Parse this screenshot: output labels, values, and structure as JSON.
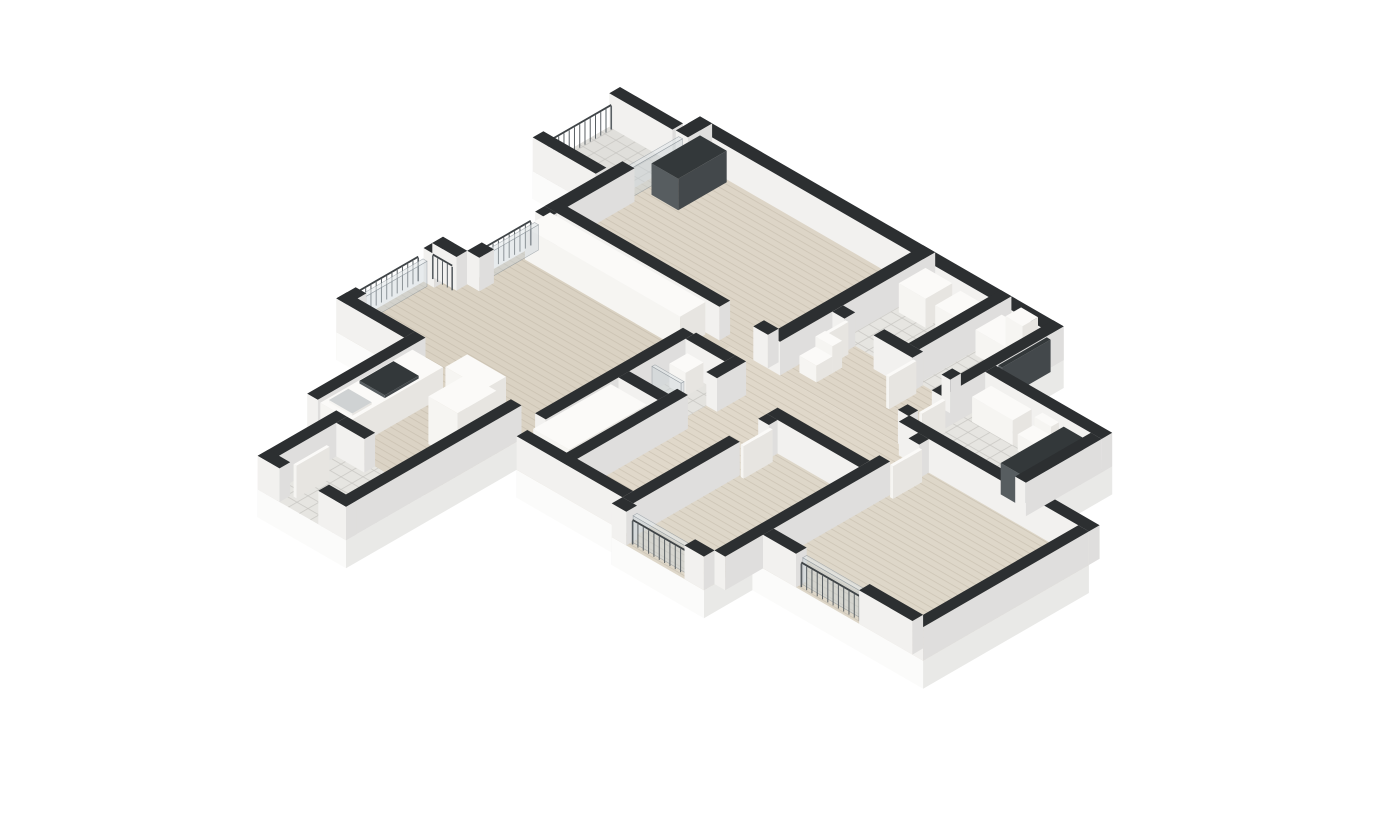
{
  "canvas": {
    "width": 1400,
    "height": 820,
    "background": "#ffffff"
  },
  "projection": {
    "cx": 700,
    "cy": 150,
    "scale": 56,
    "wall_height": 0.6,
    "rail_height": 0.42,
    "skirt_depth": 0.5
  },
  "colors": {
    "background": "#ffffff",
    "wall_top": "#2c2f31",
    "wall_face_u": "#dfdedd",
    "wall_face_v": "#f2f1ef",
    "skirt_u": "#e9e9e7",
    "skirt_v": "#fbfbfa",
    "white_top": "#fbfaf8",
    "white_u": "#e7e5e1",
    "white_v": "#f6f5f2",
    "dark_top": "#33383a",
    "dark_u": "#43484b",
    "dark_v": "#575d60",
    "sink_top": "#cfd2d3",
    "tray_top": "#f8f8f6",
    "glass_fill": "rgba(202,210,214,0.45)",
    "glass_top": "rgba(226,231,233,0.6)",
    "glass_stroke": "rgba(122,132,138,0.55)",
    "rail_bar": "#5a6064",
    "rail_top": "#3f4447",
    "wood_line": "#b7ad9c",
    "tile_line": "#c8c7c2",
    "wood_base_default": "#dcd4c6"
  },
  "scene": {
    "floors": [
      {
        "n": "balcony-floor",
        "kind": "tile",
        "base": "#e0dfdb",
        "rect": [
          -1.35,
          0.3,
          0,
          2.1
        ],
        "skirt": true
      },
      {
        "n": "bedroom-top-floor",
        "kind": "wood",
        "base": "#ddd5c7",
        "rect": [
          0,
          0,
          4.85,
          3.2
        ],
        "skirt": true
      },
      {
        "n": "bath-a-floor",
        "kind": "tile",
        "base": "#e6e5e1",
        "rect": [
          4.85,
          0,
          6.32,
          1.9
        ],
        "skirt": true
      },
      {
        "n": "bath-b-floor",
        "kind": "tile",
        "base": "#e6e5e1",
        "rect": [
          6.32,
          0,
          7.5,
          1.9
        ],
        "skirt": true
      },
      {
        "n": "hall-floor",
        "kind": "wood",
        "base": "#ded6c8",
        "rect": [
          4.85,
          1.9,
          7.5,
          3.2
        ],
        "skirt": true
      },
      {
        "n": "bathroom-2-floor",
        "kind": "tile",
        "base": "#e6e5e1",
        "rect": [
          7.5,
          1.4,
          9.9,
          3.4
        ],
        "skirt": true
      },
      {
        "n": "living-room-floor",
        "kind": "wood",
        "base": "#dad2c3",
        "pts": [
          [
            0,
            3.2
          ],
          [
            3.82,
            3.2
          ],
          [
            3.82,
            7.0
          ],
          [
            -0.5,
            7.0
          ],
          [
            -0.5,
            4.8
          ],
          [
            0,
            4.8
          ]
        ],
        "skirt": true
      },
      {
        "n": "corridor-floor",
        "kind": "wood",
        "base": "#e0d8ca",
        "rect": [
          3.82,
          3.2,
          6.0,
          7.6
        ],
        "skirt": true
      },
      {
        "n": "corridor-landing-floor",
        "kind": "wood",
        "base": "#e0d8ca",
        "rect": [
          6.0,
          3.2,
          7.9,
          4.4
        ],
        "skirt": true
      },
      {
        "n": "shower-room-floor",
        "kind": "tile",
        "base": "#e4e3df",
        "rect": [
          3.82,
          3.9,
          4.63,
          5.5
        ],
        "skirt": false
      },
      {
        "n": "kitchen-floor",
        "kind": "wood",
        "base": "#dbd3c5",
        "rect": [
          0.9,
          7.0,
          3.32,
          9.0
        ],
        "skirt": true
      },
      {
        "n": "entry-floor",
        "kind": "tile",
        "base": "#e6e5e1",
        "rect": [
          1.5,
          9.0,
          3.32,
          10.62
        ],
        "skirt": true
      },
      {
        "n": "bedroom-1-floor",
        "kind": "wood",
        "base": "#ded7c9",
        "rect": [
          6.0,
          4.4,
          7.9,
          7.82
        ],
        "skirt": true
      },
      {
        "n": "bedroom-2-floor",
        "kind": "wood",
        "base": "#ded7c9",
        "rect": [
          7.9,
          3.4,
          11.42,
          6.82
        ],
        "skirt": true
      }
    ],
    "items": [
      {
        "n": "outer-wall",
        "c": "wall",
        "r": [
          0,
          0,
          7.5,
          0.25
        ]
      },
      {
        "n": "wall",
        "c": "wall",
        "r": [
          0,
          0,
          0.25,
          0.5
        ]
      },
      {
        "n": "wall",
        "c": "wall",
        "r": [
          0,
          1.6,
          0.25,
          3.2
        ]
      },
      {
        "n": "balcony-door-glass",
        "c": "glass",
        "r": [
          0.06,
          0.5,
          0.14,
          1.6
        ],
        "h": 0.52
      },
      {
        "n": "wall",
        "c": "wall",
        "r": [
          4.6,
          0,
          4.85,
          3.2
        ]
      },
      {
        "n": "wall",
        "c": "wall",
        "r": [
          6.2,
          0,
          6.42,
          1.9
        ]
      },
      {
        "n": "wall",
        "c": "wall",
        "r": [
          4.85,
          1.9,
          5.1,
          2.12
        ]
      },
      {
        "n": "wall",
        "c": "wall",
        "r": [
          5.7,
          1.9,
          6.5,
          2.12
        ]
      },
      {
        "n": "wall",
        "c": "wall",
        "r": [
          7.1,
          1.9,
          7.28,
          2.12
        ]
      },
      {
        "n": "wall",
        "c": "wall",
        "r": [
          7.28,
          0,
          7.5,
          2.5
        ]
      },
      {
        "n": "wall",
        "c": "wall",
        "r": [
          7.28,
          3.0,
          7.5,
          3.2
        ]
      },
      {
        "n": "wall",
        "c": "wall",
        "r": [
          0,
          2.98,
          3.6,
          3.2
        ]
      },
      {
        "n": "wall",
        "c": "wall",
        "r": [
          4.3,
          2.98,
          4.6,
          3.2
        ]
      },
      {
        "n": "wall",
        "c": "wall",
        "r": [
          3.6,
          3.95,
          3.82,
          7.0
        ]
      },
      {
        "n": "wall",
        "c": "wall",
        "r": [
          0,
          3.2,
          0.25,
          3.4
        ]
      },
      {
        "n": "wall",
        "c": "wall",
        "r": [
          0,
          4.5,
          0.25,
          4.8
        ]
      },
      {
        "n": "wall",
        "c": "wall",
        "r": [
          -0.5,
          4.8,
          -0.28,
          5.2
        ]
      },
      {
        "n": "wall",
        "c": "wall",
        "r": [
          -0.5,
          6.6,
          -0.28,
          7.0
        ]
      },
      {
        "n": "wall",
        "c": "wall",
        "r": [
          -0.5,
          4.8,
          0,
          5.02
        ]
      },
      {
        "n": "wall",
        "c": "wall",
        "r": [
          -0.5,
          6.78,
          0.9,
          7.0
        ]
      },
      {
        "n": "wall",
        "c": "wall",
        "r": [
          0.9,
          6.78,
          1.12,
          9.0
        ]
      },
      {
        "n": "wall",
        "c": "wall",
        "r": [
          1.72,
          9.0,
          2.3,
          9.22
        ]
      },
      {
        "n": "wall",
        "c": "wall",
        "r": [
          1.5,
          9.0,
          1.72,
          10.62
        ]
      },
      {
        "n": "wall",
        "c": "wall",
        "r": [
          3.1,
          7.0,
          3.32,
          10.62
        ]
      },
      {
        "n": "wall",
        "c": "wall",
        "r": [
          1.5,
          10.4,
          1.95,
          10.62
        ]
      },
      {
        "n": "wall",
        "c": "wall",
        "r": [
          2.75,
          10.4,
          3.32,
          10.62
        ]
      },
      {
        "n": "wall",
        "c": "wall",
        "r": [
          4.63,
          3.9,
          4.85,
          4.5
        ]
      },
      {
        "n": "wall",
        "c": "wall",
        "r": [
          4.63,
          5.1,
          4.85,
          7.6
        ]
      },
      {
        "n": "wall",
        "c": "wall",
        "r": [
          3.82,
          3.9,
          4.63,
          4.12
        ]
      },
      {
        "n": "wall",
        "c": "wall",
        "r": [
          3.82,
          5.28,
          4.63,
          5.5
        ]
      },
      {
        "n": "wall",
        "c": "wall",
        "r": [
          3.82,
          7.38,
          6.0,
          7.6
        ]
      },
      {
        "n": "wall",
        "c": "wall",
        "r": [
          6.0,
          4.4,
          7.9,
          4.62
        ]
      },
      {
        "n": "wall",
        "c": "wall",
        "r": [
          6.0,
          4.62,
          6.22,
          4.8
        ]
      },
      {
        "n": "wall",
        "c": "wall",
        "r": [
          6.0,
          5.4,
          6.22,
          7.6
        ]
      },
      {
        "n": "wall",
        "c": "wall",
        "r": [
          6.0,
          7.6,
          6.3,
          7.82
        ]
      },
      {
        "n": "wall",
        "c": "wall",
        "r": [
          7.5,
          7.6,
          7.9,
          7.82
        ]
      },
      {
        "n": "wall",
        "c": "wall",
        "r": [
          7.9,
          3.4,
          8.12,
          3.6
        ]
      },
      {
        "n": "wall",
        "c": "wall",
        "r": [
          7.9,
          4.2,
          8.12,
          7.6
        ]
      },
      {
        "n": "wall",
        "c": "wall",
        "r": [
          7.5,
          3.18,
          11.42,
          3.4
        ]
      },
      {
        "n": "wall",
        "c": "wall",
        "r": [
          11.2,
          3.4,
          11.42,
          6.82
        ]
      },
      {
        "n": "wall",
        "c": "wall",
        "r": [
          8.12,
          6.6,
          8.8,
          6.82
        ]
      },
      {
        "n": "wall",
        "c": "wall",
        "r": [
          10.1,
          6.6,
          11.2,
          6.82
        ]
      },
      {
        "n": "wall",
        "c": "wall",
        "r": [
          7.5,
          1.4,
          9.9,
          1.62
        ]
      },
      {
        "n": "wall",
        "c": "wall",
        "r": [
          9.68,
          1.62,
          9.9,
          3.18
        ]
      },
      {
        "n": "balcony-parapet",
        "c": "wall",
        "r": [
          -1.35,
          0.3,
          -0.05,
          0.52
        ]
      },
      {
        "n": "balcony-parapet",
        "c": "wall",
        "r": [
          -1.35,
          1.88,
          -0.05,
          2.1
        ]
      },
      {
        "n": "entrance-door-panel",
        "c": "dark",
        "r": [
          7.5,
          0.35,
          7.58,
          1.35
        ],
        "h": 0.58
      },
      {
        "n": "dark-wardrobe-panel",
        "c": "dark",
        "r": [
          0.3,
          0.3,
          0.85,
          1.3
        ],
        "h": 0.56
      },
      {
        "n": "bath-niche-dark-panel",
        "c": "dark",
        "r": [
          9.25,
          1.75,
          9.66,
          3.05
        ],
        "h": 0.56
      },
      {
        "n": "closet-row",
        "c": "white",
        "r": [
          0.15,
          3.24,
          3.35,
          3.76
        ],
        "h": 0.58
      },
      {
        "n": "wardrobe-cabinet",
        "c": "white",
        "r": [
          3.86,
          5.7,
          4.6,
          7.3
        ],
        "h": 0.6
      },
      {
        "n": "kitchen-counter",
        "c": "white",
        "r": [
          1.12,
          7.05,
          1.75,
          8.95
        ],
        "h": 0.52
      },
      {
        "n": "kitchen-hob",
        "c": "dark",
        "r": [
          1.18,
          7.5,
          1.7,
          8.2
        ],
        "z": 0.52,
        "h": 0.05
      },
      {
        "n": "kitchen-sink",
        "c": "sink",
        "r": [
          1.2,
          8.45,
          1.68,
          8.85
        ],
        "z": 0.52,
        "h": 0.04
      },
      {
        "n": "kitchen-tall-cabinet",
        "c": "white",
        "r": [
          2.45,
          7.25,
          3.05,
          8.05
        ],
        "h": 0.85
      },
      {
        "n": "kitchen-peninsula",
        "c": "white",
        "r": [
          1.75,
          6.55,
          2.55,
          7.0
        ],
        "h": 0.5
      },
      {
        "n": "washer",
        "c": "white",
        "r": [
          4.95,
          0.3,
          5.5,
          0.85
        ],
        "h": 0.52
      },
      {
        "n": "bath-counter",
        "c": "white",
        "r": [
          5.65,
          0.28,
          6.15,
          0.8
        ],
        "h": 0.45
      },
      {
        "n": "storage-shelf",
        "c": "white",
        "r": [
          6.5,
          0.28,
          7.25,
          0.82
        ],
        "h": 0.45
      },
      {
        "n": "storage-column",
        "c": "white",
        "r": [
          6.9,
          0.28,
          7.25,
          0.6
        ],
        "h": 0.78
      },
      {
        "n": "wc-tank",
        "c": "white",
        "r": [
          5.0,
          2.42,
          5.35,
          2.62
        ],
        "h": 0.48
      },
      {
        "n": "wc-bowl",
        "c": "white",
        "r": [
          5.0,
          2.62,
          5.35,
          2.95
        ],
        "h": 0.3
      },
      {
        "n": "basin-counter",
        "c": "white",
        "r": [
          7.66,
          1.66,
          8.5,
          2.05
        ],
        "h": 0.45
      },
      {
        "n": "toilet-tank",
        "c": "white",
        "r": [
          8.68,
          1.62,
          9.02,
          1.78
        ],
        "h": 0.46
      },
      {
        "n": "toilet-bowl",
        "c": "white",
        "r": [
          8.65,
          1.78,
          9.05,
          2.1
        ],
        "h": 0.3
      },
      {
        "n": "shower-tray",
        "c": "tray",
        "r": [
          3.95,
          4.95,
          4.55,
          5.35
        ],
        "h": 0.1
      },
      {
        "n": "shower-glass",
        "c": "glass",
        "r": [
          3.95,
          4.88,
          4.55,
          4.94
        ],
        "z": 0.08,
        "h": 0.5
      },
      {
        "n": "shower-basin",
        "c": "white",
        "r": [
          3.92,
          4.18,
          4.25,
          4.55
        ],
        "h": 0.42
      },
      {
        "n": "door-leaf",
        "c": "white",
        "r": [
          5.12,
          2.12,
          5.18,
          2.68
        ],
        "h": 0.58
      },
      {
        "n": "door-leaf",
        "c": "white",
        "r": [
          6.52,
          2.12,
          6.58,
          2.68
        ],
        "h": 0.58
      },
      {
        "n": "door-leaf",
        "c": "white",
        "r": [
          6.26,
          4.82,
          6.32,
          5.42
        ],
        "h": 0.58
      },
      {
        "n": "door-leaf",
        "c": "white",
        "r": [
          8.16,
          3.64,
          8.22,
          4.24
        ],
        "h": 0.58
      },
      {
        "n": "door-leaf",
        "c": "white",
        "r": [
          2.0,
          9.7,
          2.06,
          10.38
        ],
        "h": 0.58
      },
      {
        "n": "door-leaf",
        "c": "white",
        "r": [
          7.52,
          2.52,
          7.58,
          3.0
        ],
        "h": 0.58
      },
      {
        "n": "window-glass",
        "c": "glass",
        "r": [
          0.04,
          3.45,
          0.12,
          4.45
        ],
        "h": 0.45
      },
      {
        "n": "window-glass",
        "c": "glass",
        "r": [
          -0.46,
          5.25,
          -0.38,
          6.55
        ],
        "h": 0.45
      },
      {
        "n": "window-glass",
        "c": "glass",
        "r": [
          6.32,
          7.62,
          7.48,
          7.7
        ],
        "h": 0.48
      },
      {
        "n": "window-glass",
        "c": "glass",
        "r": [
          8.82,
          6.62,
          10.08,
          6.7
        ],
        "h": 0.48
      },
      {
        "t": "rail",
        "n": "balcony-railing",
        "a": [
          -1.28,
          0.55
        ],
        "b": [
          -1.28,
          1.85
        ]
      },
      {
        "t": "rail",
        "n": "french-balcony-railing",
        "a": [
          -0.04,
          3.45
        ],
        "b": [
          -0.04,
          4.45
        ]
      },
      {
        "t": "rail",
        "n": "french-balcony-railing",
        "a": [
          -0.45,
          5.06
        ],
        "b": [
          -0.05,
          5.06
        ]
      },
      {
        "t": "rail",
        "n": "french-balcony-railing",
        "a": [
          -0.56,
          5.25
        ],
        "b": [
          -0.56,
          6.55
        ]
      },
      {
        "t": "rail",
        "n": "bedroom-window-railing",
        "a": [
          8.85,
          6.76
        ],
        "b": [
          10.05,
          6.76
        ]
      },
      {
        "t": "rail",
        "n": "bedroom-window-railing",
        "a": [
          6.35,
          7.74
        ],
        "b": [
          7.45,
          7.74
        ]
      }
    ]
  }
}
